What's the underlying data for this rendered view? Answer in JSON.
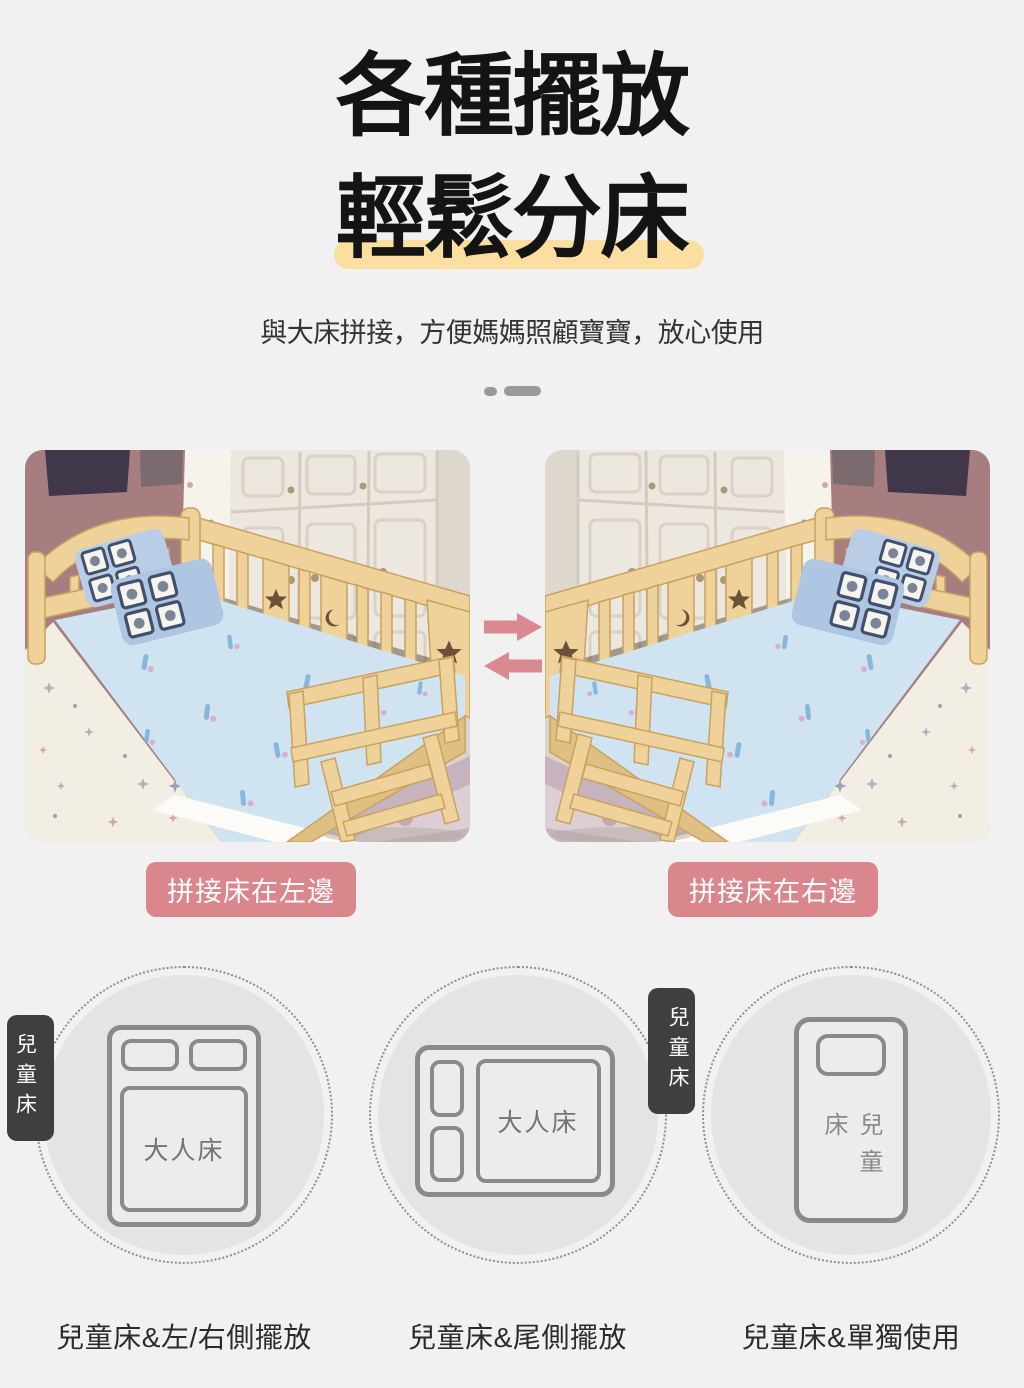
{
  "header": {
    "title_line1": "各種擺放",
    "title_line2": "輕鬆分床",
    "subtitle": "與大床拼接，方便媽媽照顧寶寶，放心使用"
  },
  "photo_section": {
    "left_photo_label": "拼接床在左邊",
    "right_photo_label": "拼接床在右邊",
    "icons": [
      "arrow-right-icon",
      "arrow-left-icon"
    ]
  },
  "placement_diagrams": {
    "items": [
      {
        "adult_bed_label": "大人床",
        "child_bed_label": "兒童床",
        "caption": "兒童床&左/右側擺放",
        "child_position": "left-side"
      },
      {
        "adult_bed_label": "大人床",
        "child_bed_label": "兒童床",
        "caption": "兒童床&尾側擺放",
        "child_position": "foot-side"
      },
      {
        "child_bed_label": "兒童床",
        "caption": "兒童床&單獨使用",
        "child_position": "standalone"
      }
    ]
  },
  "colors": {
    "background": "#f1f1f1",
    "title_text": "#141414",
    "highlight_yellow": "#fbdfa0",
    "accent_pink": "#d9868c",
    "divider_gray": "#9a9a9a",
    "circle_fill": "#e4e4e4",
    "diagram_stroke": "#8a8a8a",
    "badge_dark": "#3f3f3f"
  }
}
